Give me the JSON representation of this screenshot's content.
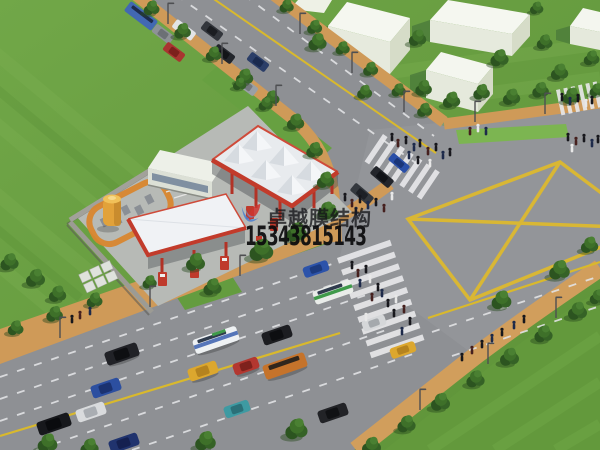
{
  "watermark": {
    "logo_icon": "brand-swoosh-logo-icon",
    "brand_text": "卓越膜结构",
    "phone_number": "15343815143",
    "text_color": "#1c1c1f",
    "logo_colors": {
      "blue": "#4a7fd0",
      "red": "#cf3530"
    }
  },
  "scene": {
    "colors": {
      "grass": "#6ba244",
      "asphalt": "#8e9094",
      "sidewalk_brick": "#cf9a58",
      "road_marking_yellow": "#ddb92f",
      "crosswalk_white": "#e9eaeb",
      "canopy_membrane_white": "#eef1f4",
      "canopy_trim_red": "#c23b2b",
      "storage_tank_orange": "#e8a83d",
      "building_white": "#f2f4ec",
      "tree_green": "#3a6a28"
    },
    "features": [
      "grass fields",
      "white block buildings",
      "tree-lined roads with traffic",
      "gas station with membrane structure canopies",
      "intersection with yellow box-junction diamond",
      "zebra crosswalks with pedestrians"
    ]
  }
}
